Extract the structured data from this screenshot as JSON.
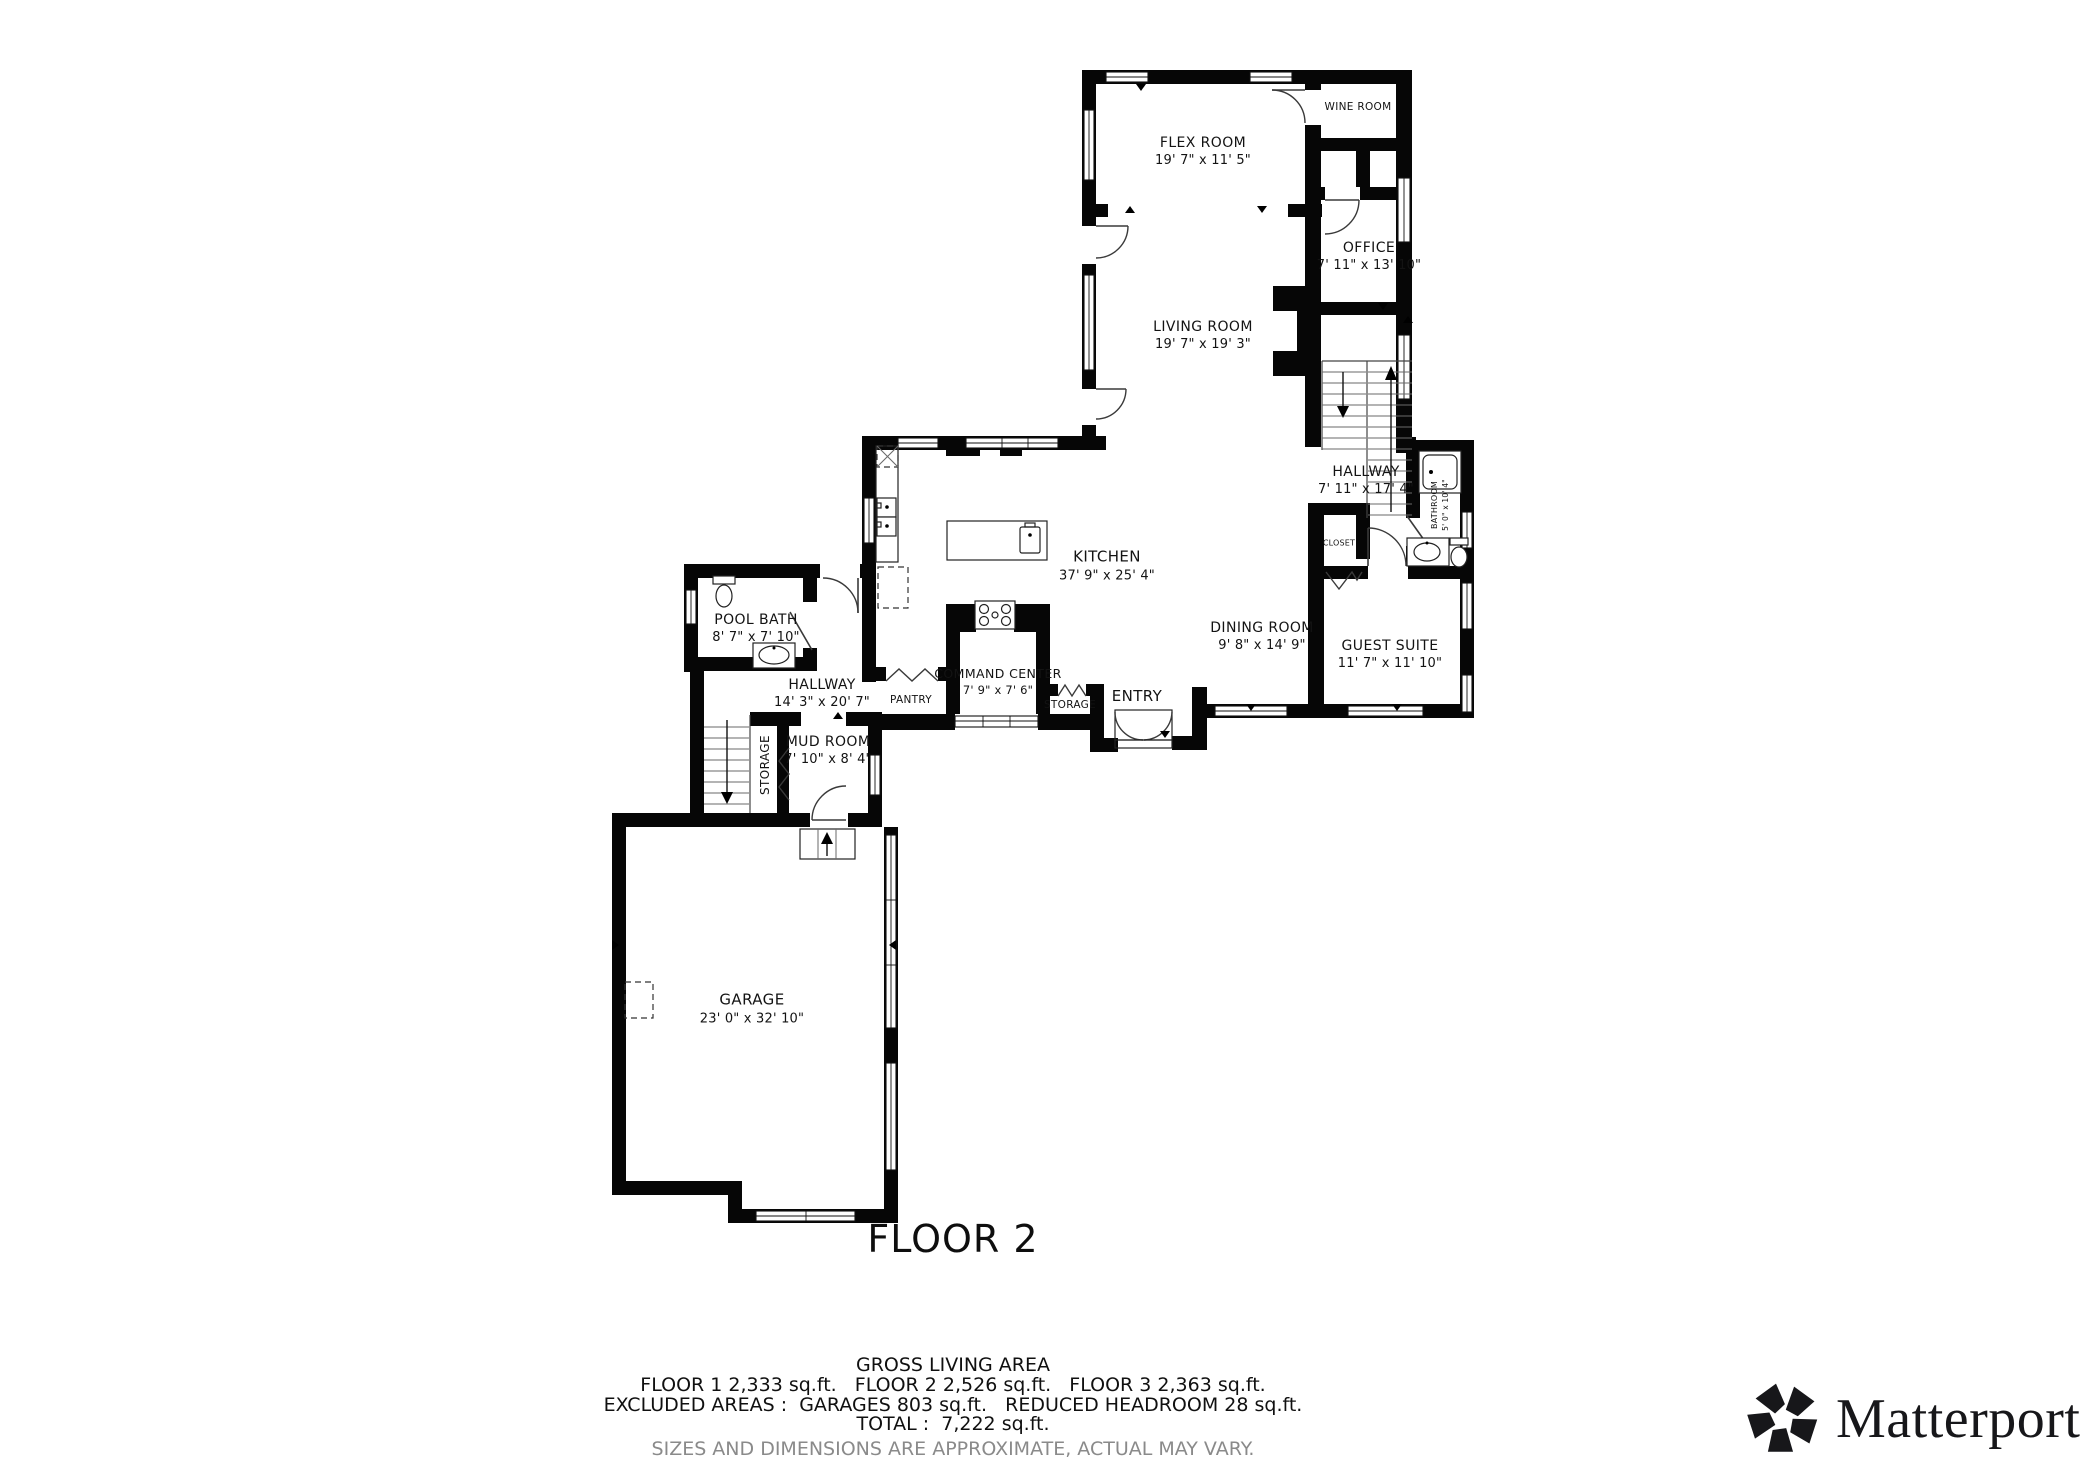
{
  "floor_title": "FLOOR 2",
  "rooms": {
    "flex": {
      "name": "FLEX ROOM",
      "dims": "19' 7\" x 11' 5\""
    },
    "wine": {
      "name": "WINE ROOM"
    },
    "office": {
      "name": "OFFICE",
      "dims": "7' 11\" x 13' 10\""
    },
    "living": {
      "name": "LIVING ROOM",
      "dims": "19' 7\" x 19' 3\""
    },
    "hallway_upper": {
      "name": "HALLWAY",
      "dims": "7' 11\" x 17' 4\""
    },
    "bathroom": {
      "name": "BATHROOM",
      "dims": "5' 0\" x 10' 4\""
    },
    "closet": {
      "name": "CLOSET"
    },
    "kitchen": {
      "name": "KITCHEN",
      "dims": "37' 9\" x 25' 4\""
    },
    "dining": {
      "name": "DINING ROOM",
      "dims": "9' 8\" x 14' 9\""
    },
    "guest": {
      "name": "GUEST SUITE",
      "dims": "11' 7\" x 11' 10\""
    },
    "pool_bath": {
      "name": "POOL BATH",
      "dims": "8' 7\" x 7' 10\""
    },
    "hallway_lower": {
      "name": "HALLWAY",
      "dims": "14' 3\" x 20' 7\""
    },
    "command_center": {
      "name": "COMMAND CENTER",
      "dims": "7' 9\" x 7' 6\""
    },
    "pantry": {
      "name": "PANTRY"
    },
    "storage_entry": {
      "name": "STORAGE"
    },
    "entry": {
      "name": "ENTRY"
    },
    "mud_room": {
      "name": "MUD ROOM",
      "dims": "7' 10\" x 8' 4\""
    },
    "storage_mud": {
      "name": "STORAGE"
    },
    "garage": {
      "name": "GARAGE",
      "dims": "23' 0\" x 32' 10\""
    }
  },
  "summary": {
    "heading": "GROSS LIVING AREA",
    "line1": "FLOOR 1 2,333 sq.ft.   FLOOR 2 2,526 sq.ft.   FLOOR 3 2,363 sq.ft.",
    "line2": "EXCLUDED AREAS :  GARAGES 803 sq.ft.   REDUCED HEADROOM 28 sq.ft.",
    "total": "TOTAL :  7,222 sq.ft.",
    "disclaimer": "SIZES AND DIMENSIONS ARE APPROXIMATE, ACTUAL MAY VARY."
  },
  "branding": {
    "logo_text": "Matterport",
    "registered_mark": "®",
    "logo_icon": "matterport-pinwheel-icon"
  }
}
